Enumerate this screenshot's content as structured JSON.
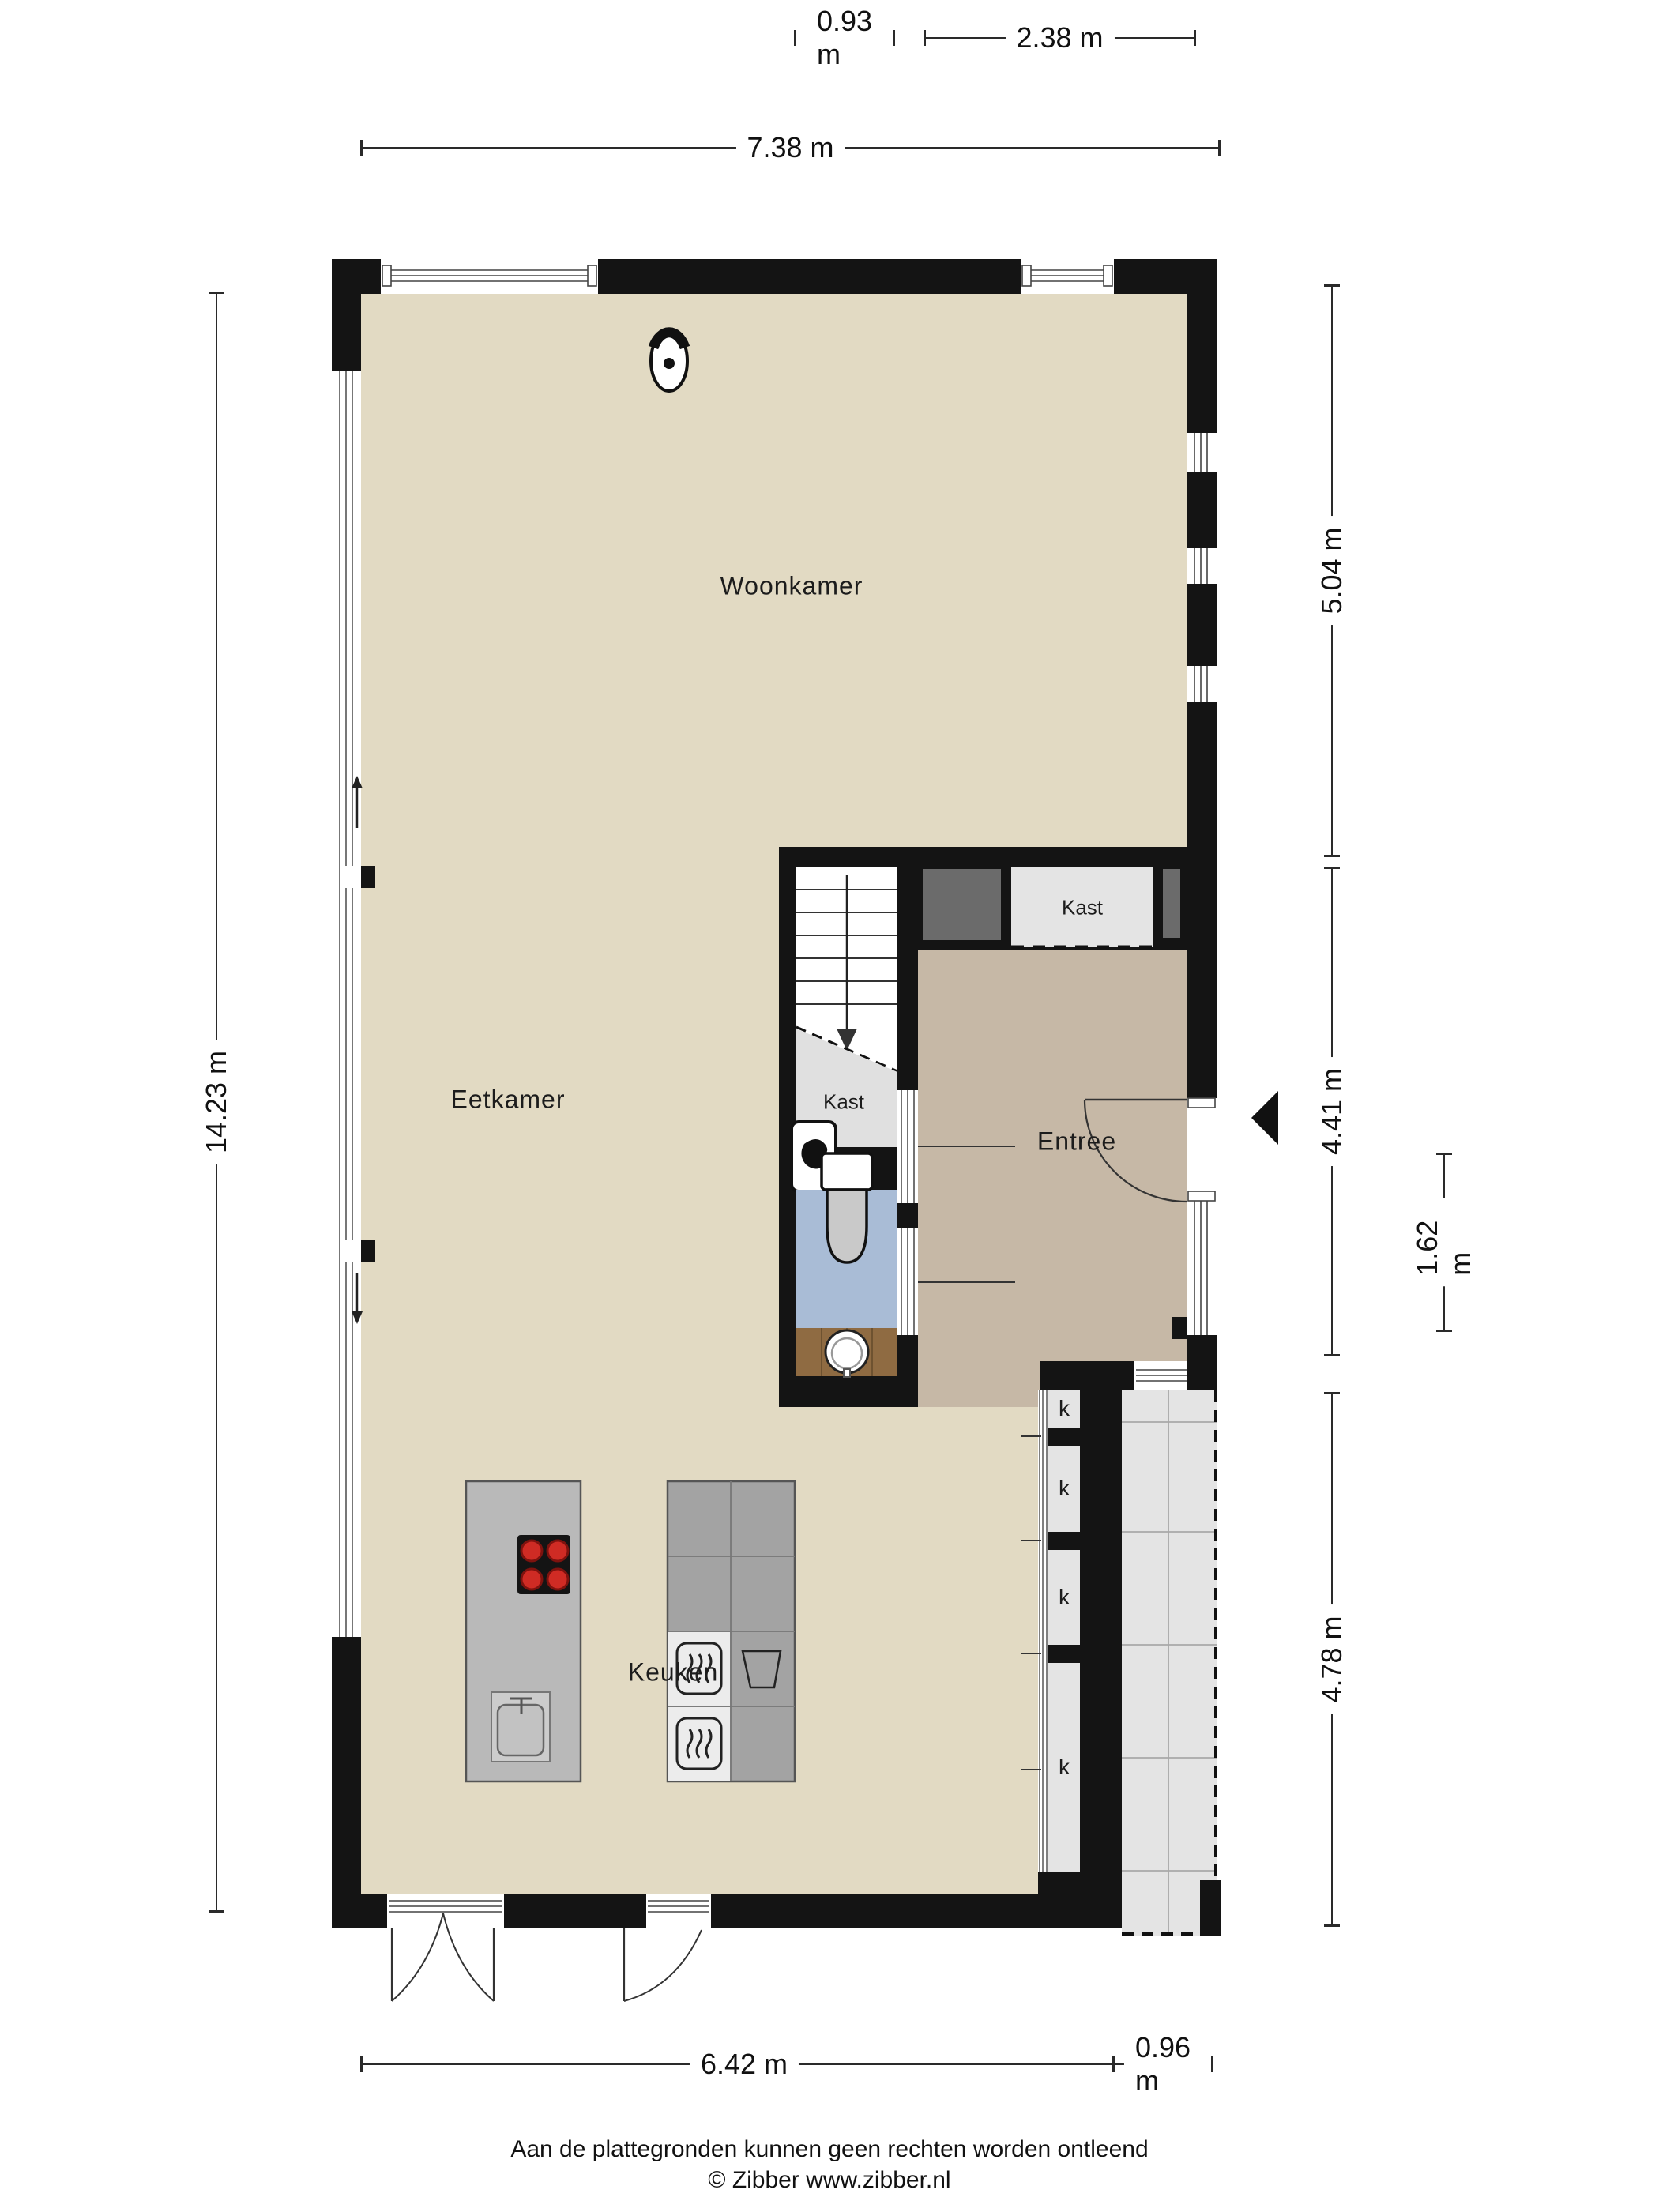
{
  "floorplan": {
    "rooms": {
      "woonkamer": "Woonkamer",
      "eetkamer": "Eetkamer",
      "keuken": "Keuken",
      "entree": "Entree",
      "kast_upper": "Kast",
      "kast_under_stairs": "Kast"
    },
    "closet_labels": [
      "k",
      "k",
      "k",
      "k"
    ],
    "dimensions": {
      "top_small": "0.93 m",
      "top_wide": "2.38 m",
      "top_total": "7.38 m",
      "left_total": "14.23 m",
      "right_upper": "5.04 m",
      "right_middle": "4.41 m",
      "right_inner": "1.62 m",
      "right_lower": "4.78 m",
      "bottom_total": "6.42 m",
      "bottom_right": "0.96 m"
    },
    "footer": {
      "disclaimer": "Aan de plattegronden kunnen geen rechten worden ontleend",
      "copyright": "© Zibber www.zibber.nl"
    },
    "icons": {
      "entrance_arrow": "left-pointing solid triangle",
      "ceiling_light": "ellipse spotlight symbol",
      "stairs_down_arrow": "arrow down",
      "window_slide_up": "arrow up",
      "window_slide_down": "arrow down"
    },
    "colors": {
      "wall": "#111111",
      "floor_main": "#E2DAC3",
      "floor_entree": "#C6B8A6",
      "floor_closet": "#E4E4E4",
      "floor_wc": "#A9BCD6",
      "floor_wood": "#8F6B42",
      "shaft_gray": "#6B6B6B",
      "terrace": "#E4E4E4",
      "burner_red": "#C1272D"
    }
  }
}
